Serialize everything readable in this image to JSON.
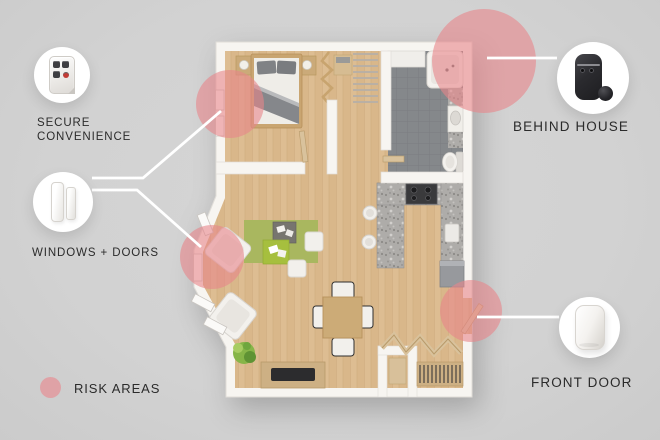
{
  "labels": {
    "secure_line1": "SECURE",
    "secure_line2": "CONVENIENCE",
    "windows_doors": "WINDOWS + DOORS",
    "behind_house": "BEHIND HOUSE",
    "front_door": "FRONT DOOR",
    "risk_areas": "RISK AREAS"
  },
  "devices": [
    {
      "name": "keyfob-remote",
      "label_ref": "secure_line1 / secure_line2"
    },
    {
      "name": "door-window-sensor",
      "label_ref": "windows_doors"
    },
    {
      "name": "outdoor-camera",
      "label_ref": "behind_house"
    },
    {
      "name": "motion-sensor",
      "label_ref": "front_door"
    }
  ],
  "risk_circles": [
    {
      "area": "bedroom-window"
    },
    {
      "area": "living-room-windows"
    },
    {
      "area": "behind-house-corner"
    },
    {
      "area": "front-door"
    }
  ],
  "colors": {
    "background": "#d2d2d2",
    "risk_pink": "#e7858a",
    "risk_legend_solid": "#dfa2a6",
    "connector_line": "#ffffff",
    "text": "#2b2b2b",
    "wall": "#f7f5f1",
    "wood_floor": "#d9b78a",
    "bathroom_tile": "#85888b",
    "granite_counter": "#aeaca9",
    "rug_green": "#a9b75f"
  }
}
